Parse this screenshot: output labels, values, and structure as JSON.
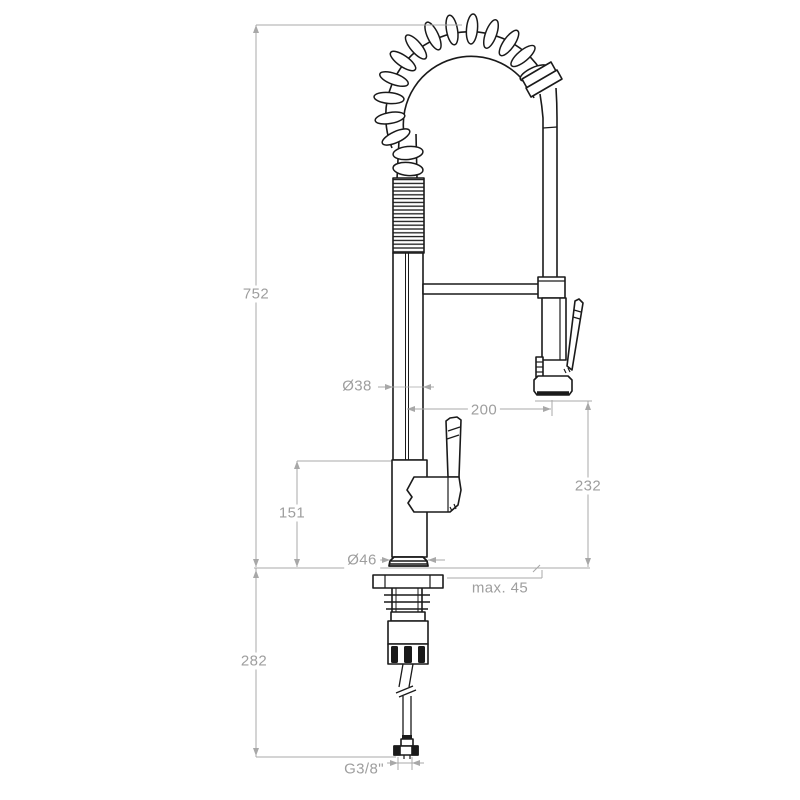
{
  "colors": {
    "background": "#ffffff",
    "drawing_line": "#1a1a1a",
    "dimension_line": "#a8a8a8",
    "dimension_text": "#9e9e9e"
  },
  "dimensions": {
    "total_height": "752",
    "spout_pipe_diameter": "Ø38",
    "spout_reach": "200",
    "outlet_to_deck_height": "232",
    "body_height": "151",
    "base_diameter": "Ø46",
    "max_deck_thickness": "max. 45",
    "below_deck_height": "282",
    "supply_connection": "G3/8\""
  }
}
